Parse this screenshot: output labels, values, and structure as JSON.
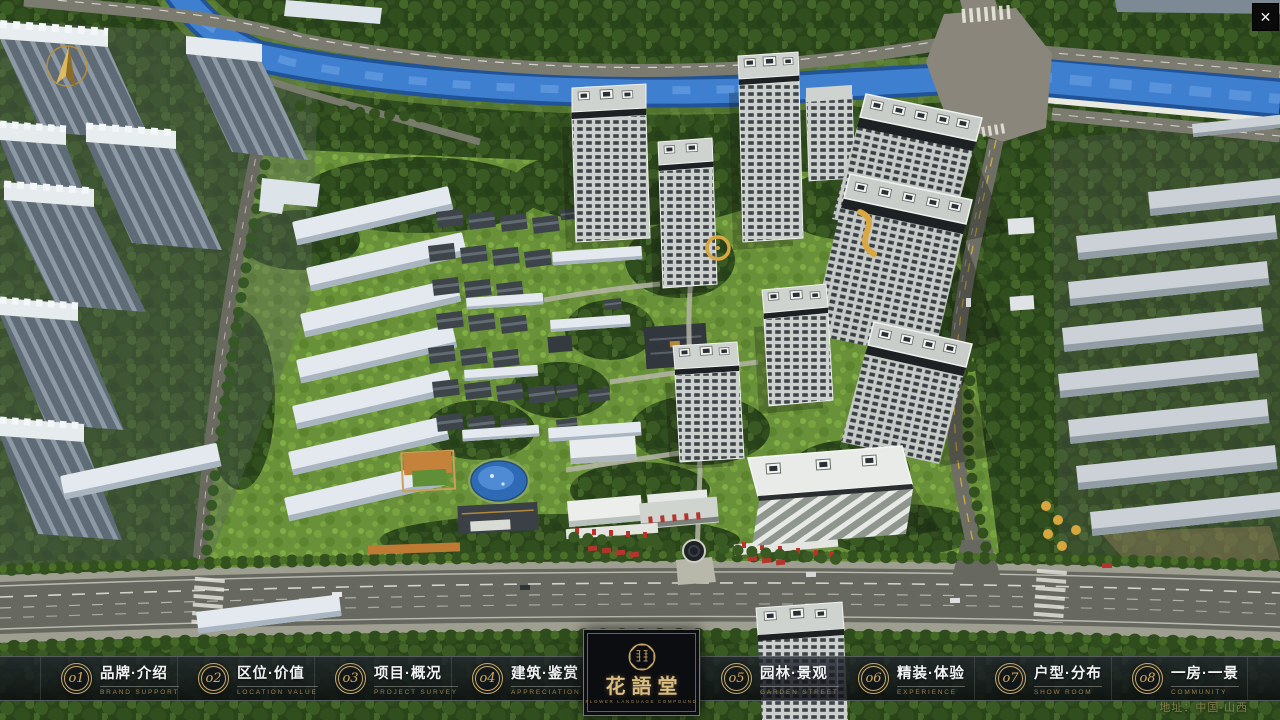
{
  "window": {
    "close_glyph": "✕"
  },
  "nav": {
    "items": [
      {
        "num": "o1",
        "label": "品牌·介绍",
        "sublabel": "BRAND SUPPORT"
      },
      {
        "num": "o2",
        "label": "区位·价值",
        "sublabel": "LOCATION VALUE"
      },
      {
        "num": "o3",
        "label": "项目·概况",
        "sublabel": "PROJECT SURVEY"
      },
      {
        "num": "o4",
        "label": "建筑·鉴赏",
        "sublabel": "APPRECIATION"
      },
      {
        "num": "o5",
        "label": "园林·景观",
        "sublabel": "GARDEN STREET"
      },
      {
        "num": "o6",
        "label": "精装·体验",
        "sublabel": "EXPERIENCE"
      },
      {
        "num": "o7",
        "label": "户型·分布",
        "sublabel": "SHOW ROOM"
      },
      {
        "num": "o8",
        "label": "一房·一景",
        "sublabel": "COMMUNITY"
      }
    ]
  },
  "logo": {
    "title": "花語堂",
    "subtitle": "FLOWER LANGUAGE COMPOUND"
  },
  "footer": {
    "address": "地址：中国·山西"
  },
  "colors": {
    "accent_gold": "#c9a86a",
    "bar_background": "rgba(16,19,26,0.80)",
    "logo_background": "#0b0d11",
    "river_blue": "#3f7fd0",
    "lawn_green": "#69913a",
    "forest_green": "#2b451b"
  }
}
